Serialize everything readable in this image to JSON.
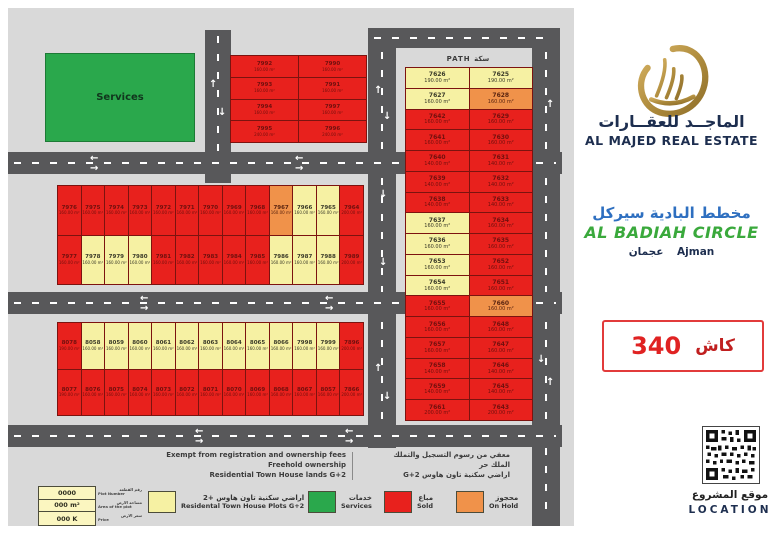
{
  "icons": {
    "arrow_up": "↑",
    "arrow_down": "↓",
    "arrow_left": "←",
    "arrow_right": "→"
  },
  "colors": {
    "sold": "#e8211d",
    "available": "#f6f1a3",
    "on_hold": "#f0924a",
    "services": "#2aa84c",
    "road": "#58585a",
    "accent_red": "#e02222",
    "brand_navy": "#1d2e4f",
    "title_blue": "#2e6fc0",
    "title_green": "#3aa93c"
  },
  "map": {
    "path_label": "PATH  سكة",
    "services_label": "Services",
    "blocks": [
      {
        "name": "top-block",
        "cols": 2,
        "cells": [
          {
            "n": "7992",
            "a": "160.00 m²",
            "c": "r"
          },
          {
            "n": "7990",
            "a": "160.00 m²",
            "c": "r"
          },
          {
            "n": "7993",
            "a": "160.00 m²",
            "c": "r"
          },
          {
            "n": "7991",
            "a": "160.00 m²",
            "c": "r"
          },
          {
            "n": "7994",
            "a": "160.00 m²",
            "c": "r"
          },
          {
            "n": "7997",
            "a": "160.00 m²",
            "c": "r"
          },
          {
            "n": "7995",
            "a": "240.00 m²",
            "c": "r"
          },
          {
            "n": "7996",
            "a": "240.00 m²",
            "c": "r"
          }
        ]
      },
      {
        "name": "middle-block",
        "cols": 13,
        "cells": [
          {
            "n": "7976",
            "a": "160.00 m²",
            "c": "r"
          },
          {
            "n": "7975",
            "a": "160.00 m²",
            "c": "r"
          },
          {
            "n": "7974",
            "a": "160.00 m²",
            "c": "r"
          },
          {
            "n": "7973",
            "a": "160.00 m²",
            "c": "r"
          },
          {
            "n": "7972",
            "a": "160.00 m²",
            "c": "r"
          },
          {
            "n": "7971",
            "a": "160.00 m²",
            "c": "r"
          },
          {
            "n": "7970",
            "a": "160.00 m²",
            "c": "r"
          },
          {
            "n": "7969",
            "a": "160.00 m²",
            "c": "r"
          },
          {
            "n": "7968",
            "a": "160.00 m²",
            "c": "r"
          },
          {
            "n": "7967",
            "a": "160.00 m²",
            "c": "o"
          },
          {
            "n": "7966",
            "a": "160.00 m²",
            "c": "y"
          },
          {
            "n": "7965",
            "a": "160.00 m²",
            "c": "y"
          },
          {
            "n": "7964",
            "a": "200.00 m²",
            "c": "r"
          },
          {
            "n": "7977",
            "a": "160.00 m²",
            "c": "r"
          },
          {
            "n": "7978",
            "a": "160.00 m²",
            "c": "y"
          },
          {
            "n": "7979",
            "a": "160.00 m²",
            "c": "y"
          },
          {
            "n": "7980",
            "a": "160.00 m²",
            "c": "y"
          },
          {
            "n": "7981",
            "a": "160.00 m²",
            "c": "r"
          },
          {
            "n": "7982",
            "a": "160.00 m²",
            "c": "r"
          },
          {
            "n": "7983",
            "a": "160.00 m²",
            "c": "r"
          },
          {
            "n": "7984",
            "a": "160.00 m²",
            "c": "r"
          },
          {
            "n": "7985",
            "a": "160.00 m²",
            "c": "r"
          },
          {
            "n": "7986",
            "a": "160.00 m²",
            "c": "y"
          },
          {
            "n": "7987",
            "a": "160.00 m²",
            "c": "y"
          },
          {
            "n": "7988",
            "a": "160.00 m²",
            "c": "y"
          },
          {
            "n": "7989",
            "a": "200.00 m²",
            "c": "r"
          }
        ]
      },
      {
        "name": "bottom-block",
        "cols": 13,
        "cells": [
          {
            "n": "8078",
            "a": "190.00 m²",
            "c": "r"
          },
          {
            "n": "8058",
            "a": "160.00 m²",
            "c": "y"
          },
          {
            "n": "8059",
            "a": "160.00 m²",
            "c": "y"
          },
          {
            "n": "8060",
            "a": "160.00 m²",
            "c": "y"
          },
          {
            "n": "8061",
            "a": "160.00 m²",
            "c": "y"
          },
          {
            "n": "8062",
            "a": "160.00 m²",
            "c": "y"
          },
          {
            "n": "8063",
            "a": "160.00 m²",
            "c": "y"
          },
          {
            "n": "8064",
            "a": "160.00 m²",
            "c": "y"
          },
          {
            "n": "8065",
            "a": "160.00 m²",
            "c": "y"
          },
          {
            "n": "8066",
            "a": "160.00 m²",
            "c": "y"
          },
          {
            "n": "7998",
            "a": "160.00 m²",
            "c": "y"
          },
          {
            "n": "7999",
            "a": "160.00 m²",
            "c": "y"
          },
          {
            "n": "7896",
            "a": "200.00 m²",
            "c": "r"
          },
          {
            "n": "8077",
            "a": "190.00 m²",
            "c": "r"
          },
          {
            "n": "8076",
            "a": "160.00 m²",
            "c": "r"
          },
          {
            "n": "8075",
            "a": "160.00 m²",
            "c": "r"
          },
          {
            "n": "8074",
            "a": "160.00 m²",
            "c": "r"
          },
          {
            "n": "8073",
            "a": "160.00 m²",
            "c": "r"
          },
          {
            "n": "8072",
            "a": "160.00 m²",
            "c": "r"
          },
          {
            "n": "8071",
            "a": "160.00 m²",
            "c": "r"
          },
          {
            "n": "8070",
            "a": "160.00 m²",
            "c": "r"
          },
          {
            "n": "8069",
            "a": "160.00 m²",
            "c": "r"
          },
          {
            "n": "8068",
            "a": "160.00 m²",
            "c": "r"
          },
          {
            "n": "8067",
            "a": "160.00 m²",
            "c": "r"
          },
          {
            "n": "8057",
            "a": "160.00 m²",
            "c": "r"
          },
          {
            "n": "7866",
            "a": "200.00 m²",
            "c": "r"
          }
        ]
      },
      {
        "name": "right-block",
        "cols": 2,
        "cells": [
          {
            "n": "7626",
            "a": "190.00 m²",
            "c": "y"
          },
          {
            "n": "7625",
            "a": "190.00 m²",
            "c": "y"
          },
          {
            "n": "7627",
            "a": "160.00 m²",
            "c": "y"
          },
          {
            "n": "7628",
            "a": "160.00 m²",
            "c": "o"
          },
          {
            "n": "7642",
            "a": "160.00 m²",
            "c": "r"
          },
          {
            "n": "7629",
            "a": "160.00 m²",
            "c": "r"
          },
          {
            "n": "7641",
            "a": "160.00 m²",
            "c": "r"
          },
          {
            "n": "7630",
            "a": "160.00 m²",
            "c": "r"
          },
          {
            "n": "7640",
            "a": "140.00 m²",
            "c": "r"
          },
          {
            "n": "7631",
            "a": "140.00 m²",
            "c": "r"
          },
          {
            "n": "7639",
            "a": "140.00 m²",
            "c": "r"
          },
          {
            "n": "7632",
            "a": "140.00 m²",
            "c": "r"
          },
          {
            "n": "7638",
            "a": "140.00 m²",
            "c": "r"
          },
          {
            "n": "7633",
            "a": "140.00 m²",
            "c": "r"
          },
          {
            "n": "7637",
            "a": "160.00 m²",
            "c": "y"
          },
          {
            "n": "7634",
            "a": "160.00 m²",
            "c": "r"
          },
          {
            "n": "7636",
            "a": "160.00 m²",
            "c": "y"
          },
          {
            "n": "7635",
            "a": "160.00 m²",
            "c": "r"
          },
          {
            "n": "7653",
            "a": "160.00 m²",
            "c": "y"
          },
          {
            "n": "7652",
            "a": "160.00 m²",
            "c": "r"
          },
          {
            "n": "7654",
            "a": "160.00 m²",
            "c": "y"
          },
          {
            "n": "7651",
            "a": "160.00 m²",
            "c": "r"
          },
          {
            "n": "7655",
            "a": "160.00 m²",
            "c": "r"
          },
          {
            "n": "7660",
            "a": "160.00 m²",
            "c": "o"
          },
          {
            "n": "7656",
            "a": "160.00 m²",
            "c": "r"
          },
          {
            "n": "7648",
            "a": "160.00 m²",
            "c": "r"
          },
          {
            "n": "7657",
            "a": "160.00 m²",
            "c": "r"
          },
          {
            "n": "7647",
            "a": "160.00 m²",
            "c": "r"
          },
          {
            "n": "7658",
            "a": "140.00 m²",
            "c": "r"
          },
          {
            "n": "7646",
            "a": "140.00 m²",
            "c": "r"
          },
          {
            "n": "7659",
            "a": "140.00 m²",
            "c": "r"
          },
          {
            "n": "7645",
            "a": "140.00 m²",
            "c": "r"
          },
          {
            "n": "7661",
            "a": "200.00 m²",
            "c": "r"
          },
          {
            "n": "7643",
            "a": "200.00 m²",
            "c": "r"
          }
        ]
      }
    ],
    "notes": {
      "en": [
        "Exempt from registration and ownership fees",
        "Freehold ownership",
        "Residential Town House lands G+2"
      ],
      "ar": [
        "معفي من رسوم التسجيل والتملك",
        "الملك حر",
        "اراضي سكنية تاون هاوس G+2"
      ]
    },
    "legend": {
      "key": {
        "number": "0000",
        "area": "000 m²",
        "price": "000 K",
        "rows": [
          {
            "ar": "رقم القطعة",
            "en": "Plot Number"
          },
          {
            "ar": "مساحة الارض",
            "en": "Area of the plot"
          },
          {
            "ar": "سعر الارض",
            "en": "Price"
          }
        ]
      },
      "items": [
        {
          "color": "#f6f1a3",
          "ar": "اراضي سكنية تاون هاوس +2",
          "en": "Residental Town House Plots G+2"
        },
        {
          "color": "#2aa84c",
          "ar": "خدمات",
          "en": "Services"
        },
        {
          "color": "#e8211d",
          "ar": "مباع",
          "en": "Sold"
        },
        {
          "color": "#f0924a",
          "ar": "محجوز",
          "en": "On Hold"
        }
      ]
    }
  },
  "panel": {
    "brand_ar": "الماجــد للعقــارات",
    "brand_en": "AL MAJED REAL ESTATE",
    "title_ar": "مخطط البادية سيركل",
    "title_en": "AL BADIAH CIRCLE",
    "city_ar": "عجمان",
    "city_en": "Ajman",
    "cash_number": "340",
    "cash_word": "كاش",
    "qr_label_ar": "موقع المشروع",
    "qr_label_en": "LOCATION"
  }
}
